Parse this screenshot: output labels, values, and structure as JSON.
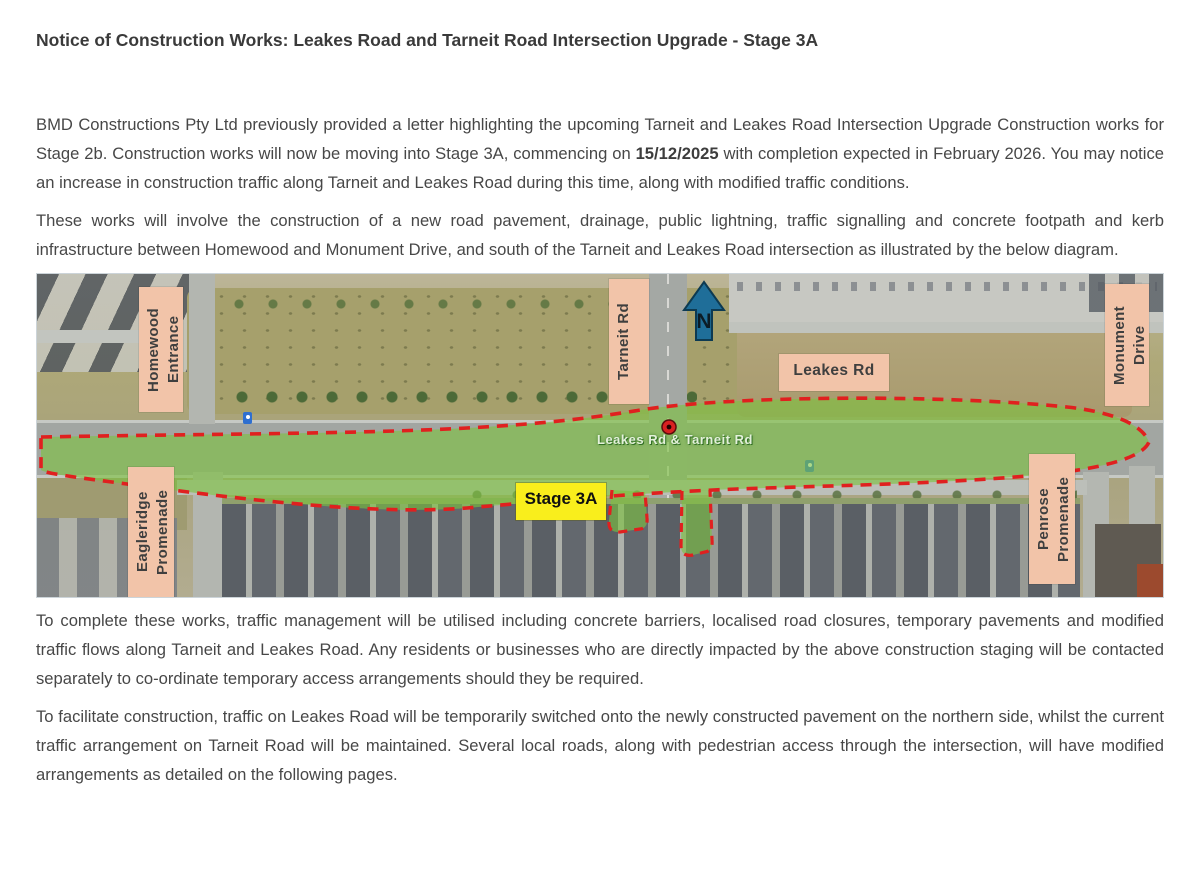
{
  "theme": {
    "label-pink": "#f2c4a9",
    "stage-yellow": "#f9ee1c",
    "dash-red": "#e0201f",
    "zone-green": "#7cc23f",
    "north-blue": "#1f6e99",
    "text-color": "#474747",
    "title-color": "#3a3a3a"
  },
  "document": {
    "title": "Notice of Construction Works: Leakes Road and Tarneit Road Intersection Upgrade - Stage 3A",
    "p1": {
      "part1": "BMD Constructions Pty Ltd previously provided a letter highlighting the upcoming Tarneit and Leakes Road Intersection Upgrade Construction works for Stage 2b. Construction works will now be moving into Stage 3A, commencing on ",
      "bold_date": "15/12/2025",
      "part2": " with completion expected in February 2026. You may notice an increase in construction traffic along Tarneit and Leakes Road during this time, along with modified traffic conditions."
    },
    "p2": "These works will involve the construction of a new road pavement, drainage, public lightning, traffic signalling and concrete footpath and kerb infrastructure between Homewood and Monument Drive, and south of the Tarneit and Leakes Road intersection as illustrated by the below diagram.",
    "p3": "To complete these works, traffic management will be utilised including concrete barriers, localised road closures, temporary pavements and modified traffic flows along Tarneit and Leakes Road. Any residents or businesses who are directly impacted by the above construction staging will be contacted separately to co-ordinate temporary access arrangements should they be required.",
    "p4": "To facilitate construction, traffic on Leakes Road will be temporarily switched onto the newly constructed pavement on the northern side, whilst the current traffic arrangement on Tarneit Road will be maintained. Several local roads, along with pedestrian access through the intersection, will have modified arrangements as detailed on the following pages."
  },
  "map": {
    "north_label": "N",
    "stage_label": "Stage 3A",
    "road_caption": "Leakes Rd & Tarneit Rd",
    "labels": {
      "homewood": "Homewood\nEntrance",
      "tarneit": "Tarneit Rd",
      "leakes": "Leakes Rd",
      "monument": "Monument\nDrive",
      "eagleridge": "Eagleridge\nPromenade",
      "penrose": "Penrose\nPromenade"
    }
  }
}
